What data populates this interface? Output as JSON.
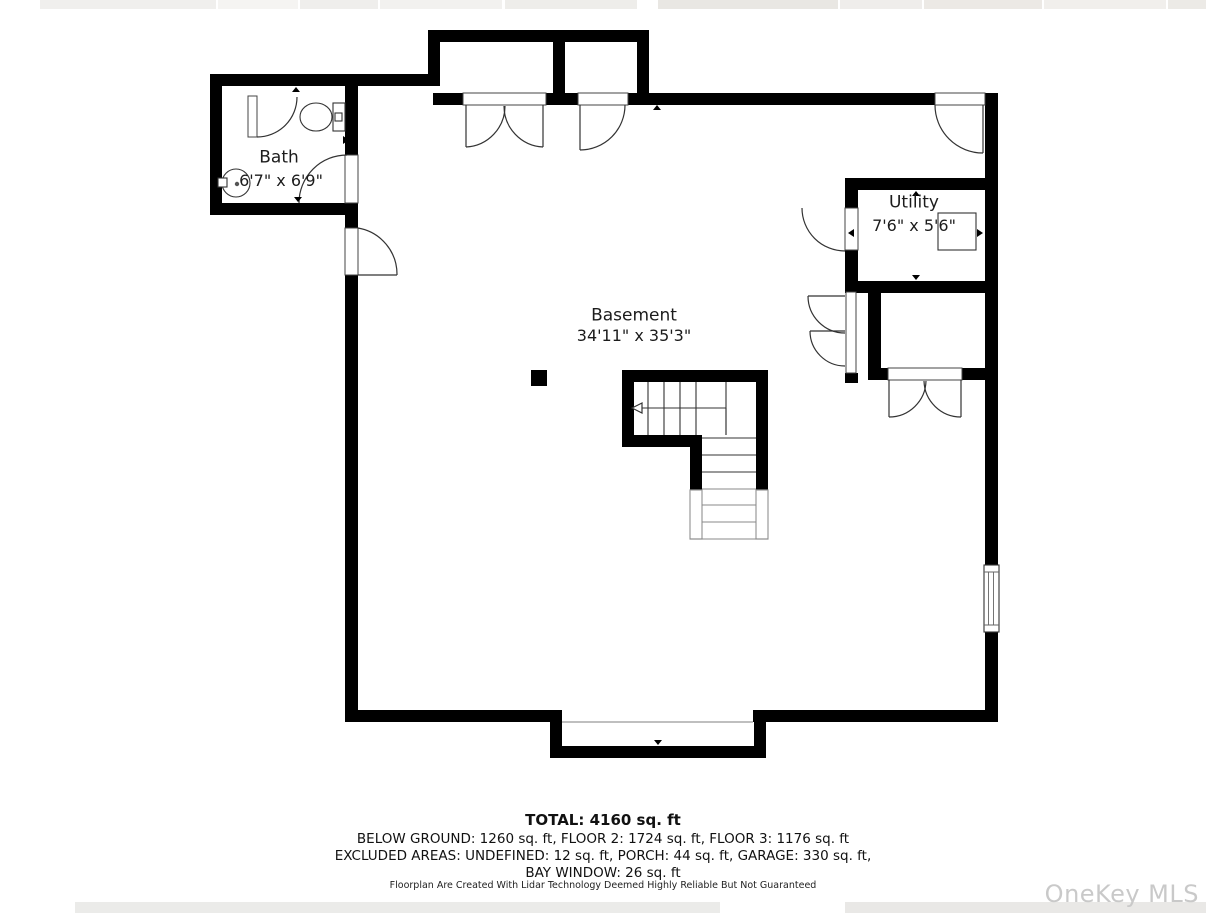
{
  "gallery": {
    "top_strip_note": "edges of adjacent listing photos",
    "bottom_strip_note": "edges of adjacent listing photos"
  },
  "rooms": {
    "bath": {
      "name": "Bath",
      "dims": "6'7\" x 6'9\""
    },
    "utility": {
      "name": "Utility",
      "dims": "7'6\" x 5'6\""
    },
    "basement": {
      "name": "Basement",
      "dims": "34'11\" x 35'3\""
    }
  },
  "summary": {
    "total": "TOTAL: 4160 sq. ft",
    "line1": "BELOW GROUND: 1260 sq. ft, FLOOR 2: 1724 sq. ft, FLOOR 3: 1176 sq. ft",
    "line2": "EXCLUDED AREAS: UNDEFINED: 12 sq. ft, PORCH: 44 sq. ft, GARAGE: 330 sq. ft,",
    "line3": "BAY WINDOW: 26 sq. ft"
  },
  "disclaimer": "Floorplan Are Created With Lidar Technology Deemed Highly Reliable But Not Guaranteed",
  "watermark": "OneKey MLS",
  "icons": {
    "toilet": "toilet-icon",
    "sink": "sink-icon",
    "stairs": "staircase",
    "post": "support-post",
    "window": "window-symbol",
    "water_heater": "utility-fixture"
  },
  "colors": {
    "wall": "#000000",
    "door_line": "#333333",
    "cut_line": "#999999",
    "watermark": "#c9c9c9",
    "thumb_gray": "#edecea"
  }
}
